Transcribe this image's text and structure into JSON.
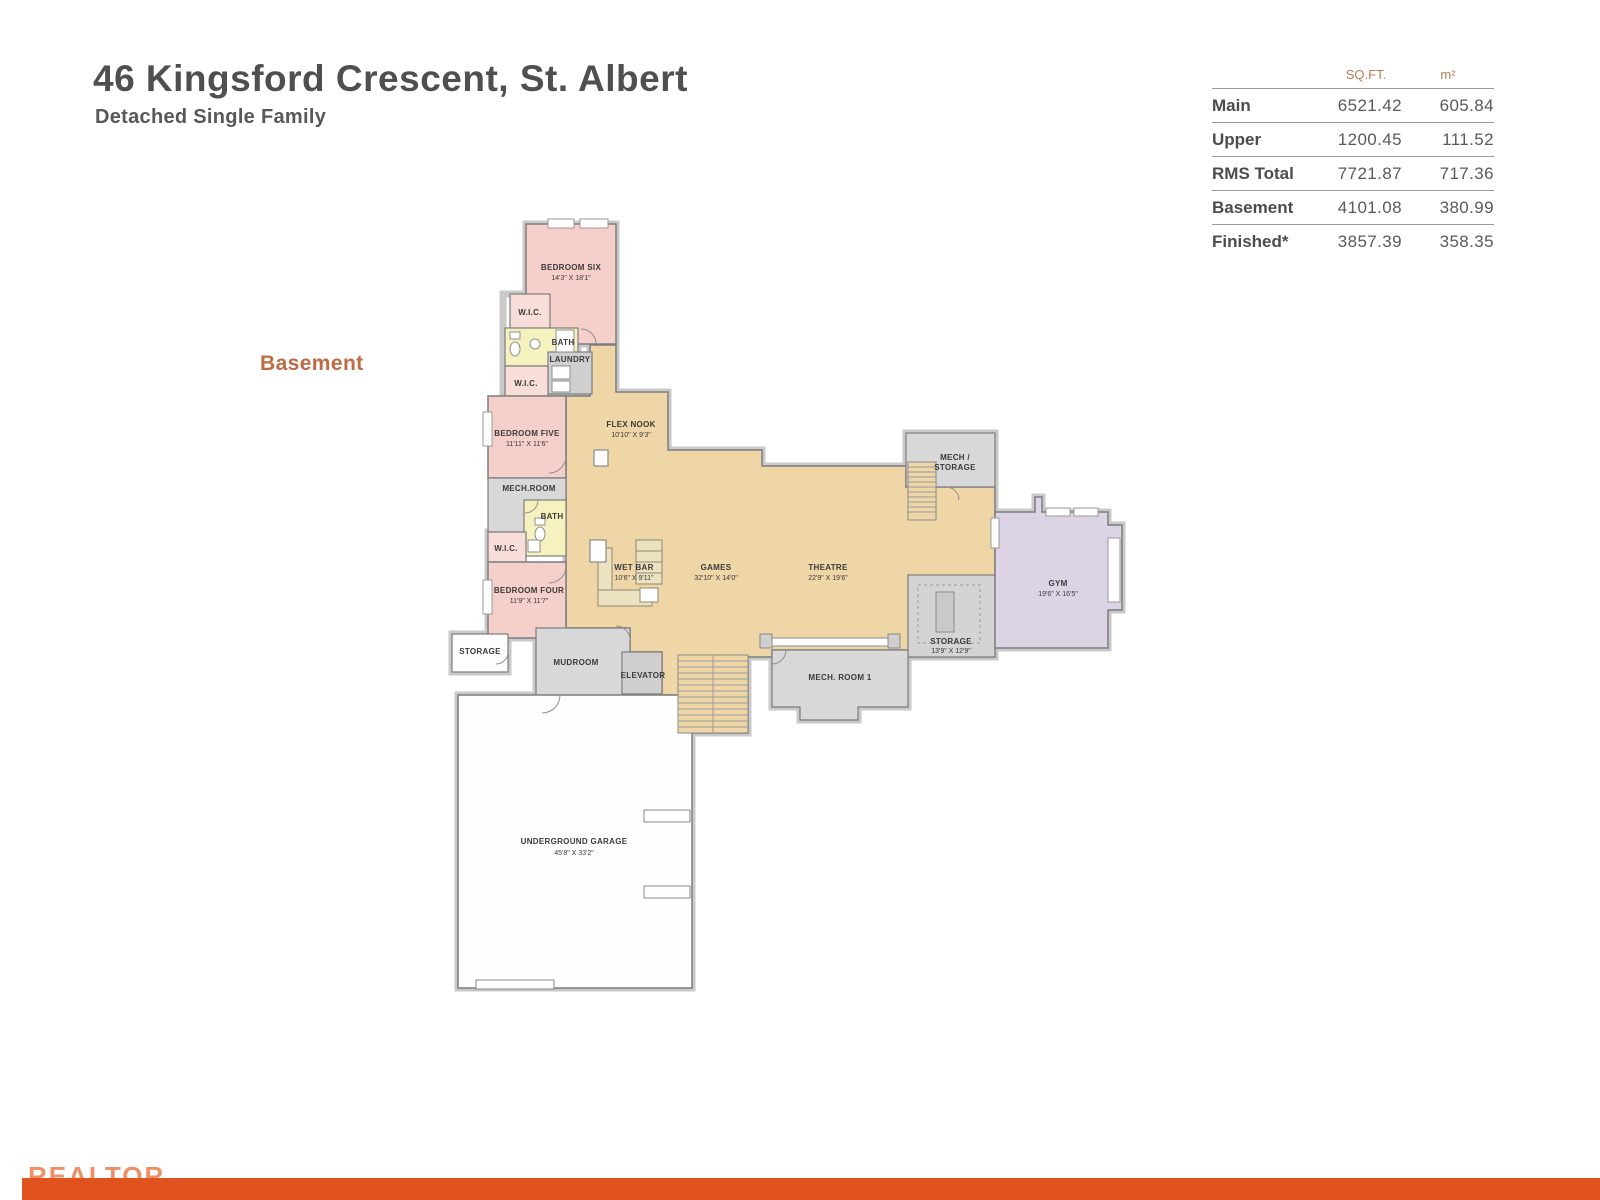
{
  "header": {
    "title": "46 Kingsford Crescent, St. Albert",
    "subtitle": "Detached Single Family"
  },
  "floor_label": "Basement",
  "area_table": {
    "col_headers": {
      "sqft": "SQ.FT.",
      "m2": "m²"
    },
    "rows": [
      {
        "label": "Main",
        "sqft": "6521.42",
        "m2": "605.84"
      },
      {
        "label": "Upper",
        "sqft": "1200.45",
        "m2": "111.52"
      },
      {
        "label": "RMS Total",
        "sqft": "7721.87",
        "m2": "717.36"
      },
      {
        "label": "Basement",
        "sqft": "4101.08",
        "m2": "380.99"
      },
      {
        "label": "Finished*",
        "sqft": "3857.39",
        "m2": "358.35"
      }
    ]
  },
  "plan": {
    "rooms": [
      {
        "label": "BEDROOM SIX",
        "dims": "14'3\" X 18'1\""
      },
      {
        "label": "W.I.C."
      },
      {
        "label": "BATH"
      },
      {
        "label": "LAUNDRY"
      },
      {
        "label": "W.I.C."
      },
      {
        "label": "BEDROOM FIVE",
        "dims": "11'11\" X 11'6\""
      },
      {
        "label": "FLEX NOOK",
        "dims": "10'10\" X 9'3\""
      },
      {
        "label": "MECH.ROOM"
      },
      {
        "label": "BATH"
      },
      {
        "label": "W.I.C."
      },
      {
        "label": "BEDROOM FOUR",
        "dims": "11'9\" X 11'7\""
      },
      {
        "label": "STORAGE"
      },
      {
        "label": "MUDROOM"
      },
      {
        "label": "ELEVATOR"
      },
      {
        "label": "WET BAR",
        "dims": "10'6\" X 9'11\""
      },
      {
        "label": "GAMES",
        "dims": "32'10\" X 14'0\""
      },
      {
        "label": "THEATRE",
        "dims": "22'9\" X 19'6\""
      },
      {
        "line1": "MECH /",
        "line2": "STORAGE"
      },
      {
        "label": "STORAGE",
        "dims": "13'9\" X 12'9\""
      },
      {
        "label": "GYM",
        "dims": "19'6\" X 16'5\""
      },
      {
        "label": "MECH. ROOM 1"
      },
      {
        "label": "UNDERGROUND GARAGE",
        "dims": "45'8\" X 33'2\""
      }
    ],
    "colors": {
      "bedroom": "#f5cfc9",
      "closet": "#f8ddd8",
      "bath": "#f5f2c0",
      "living": "#efd6a7",
      "utility": "#d8d8d8",
      "gym": "#dcd4e4",
      "accent": "#bf6b45"
    }
  },
  "footer": {
    "watermark": "REALTOR",
    "bar_color": "#e0521e"
  }
}
